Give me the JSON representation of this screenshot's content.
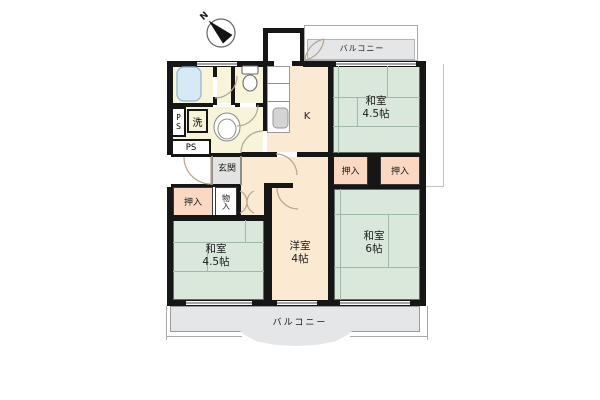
{
  "floorplan": {
    "compass": {
      "north_label": "N"
    },
    "balconies": {
      "top_label": "バルコニー",
      "bottom_label": "バルコニー"
    },
    "rooms": {
      "tatami_northeast": {
        "name": "和室",
        "size": "4.5帖"
      },
      "tatami_southeast": {
        "name": "和室",
        "size": "6帖"
      },
      "tatami_southwest": {
        "name": "和室",
        "size": "4.5帖"
      },
      "western_room": {
        "name": "洋室",
        "size": "4帖"
      },
      "kitchen_label": "K",
      "entrance_label": "玄関"
    },
    "closets": {
      "oshiire_label": "押入",
      "monoire_label": "物入"
    },
    "utilities": {
      "laundry_label": "洗",
      "pipe_space_label": "PS"
    },
    "colors": {
      "wall": "#161616",
      "tatami_green": "#d9e8db",
      "closet_pink": "#fad8c4",
      "flooring_cream": "#fce9d2",
      "wet_area_yellow": "#f8f4d9",
      "entrance_gray": "#e3e3e1",
      "balcony_gray": "#e5e6e8",
      "bathtub_blue": "#d6eaf5"
    }
  }
}
